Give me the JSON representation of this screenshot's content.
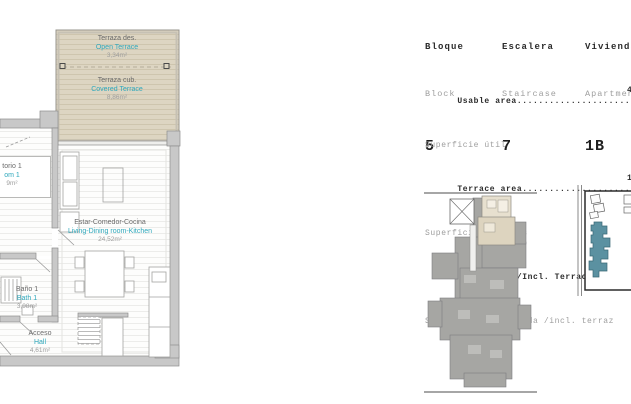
{
  "floor_plan": {
    "labels": {
      "open_terrace": {
        "es": "Terraza des.",
        "en": "Open Terrace",
        "area": "3,34m²"
      },
      "covered_terrace": {
        "es": "Terraza cub.",
        "en": "Covered Terrace",
        "area": "8,86m²"
      },
      "living": {
        "es": "Estar-Comedor-Cocina",
        "en": "Living-Dining room-Kitchen",
        "area": "24,52m²"
      },
      "bedroom": {
        "es": "torio 1",
        "en": "om 1",
        "area": "9m²"
      },
      "bath": {
        "es": "Baño 1",
        "en": "Bath 1",
        "area": "3,98m²"
      },
      "hall": {
        "es": "Acceso",
        "en": "Hall",
        "area": "4,61m²"
      }
    },
    "colors": {
      "room_name_en": "#2fa8bc",
      "room_name_es": "#6a6a6a",
      "area_text": "#9d9d9d",
      "terrace_fill": "#ddd5c2",
      "wall_fill": "#c8c8c8"
    }
  },
  "unit_info": {
    "block": {
      "label_es": "Bloque",
      "label_en": "Block",
      "value": "5"
    },
    "staircase": {
      "label_es": "Escalera",
      "label_en": "Staircase",
      "value": "7"
    },
    "apartment": {
      "label_es": "Vivienda",
      "label_en": "Apartment",
      "value": "1B"
    }
  },
  "areas": {
    "rows": [
      {
        "label_en": "Usable area",
        "dots": "........................",
        "value": "4",
        "label_es": "Superficie útil"
      },
      {
        "label_en": "Terrace area",
        "dots": ".......................",
        "value": "1",
        "label_es": "Superficie terrazas"
      },
      {
        "label_en": "Built area /Incl. Terrace/ ",
        "dots": "...... ",
        "value": "6",
        "label_es": "Superficie construida /incl. terraz"
      }
    ]
  },
  "minimaps": {
    "key_plan": {
      "highlight_color": "#ddd4bf",
      "building_color": "#a6a6a3"
    },
    "site_plan": {
      "highlight_color": "#5b91a1"
    }
  }
}
